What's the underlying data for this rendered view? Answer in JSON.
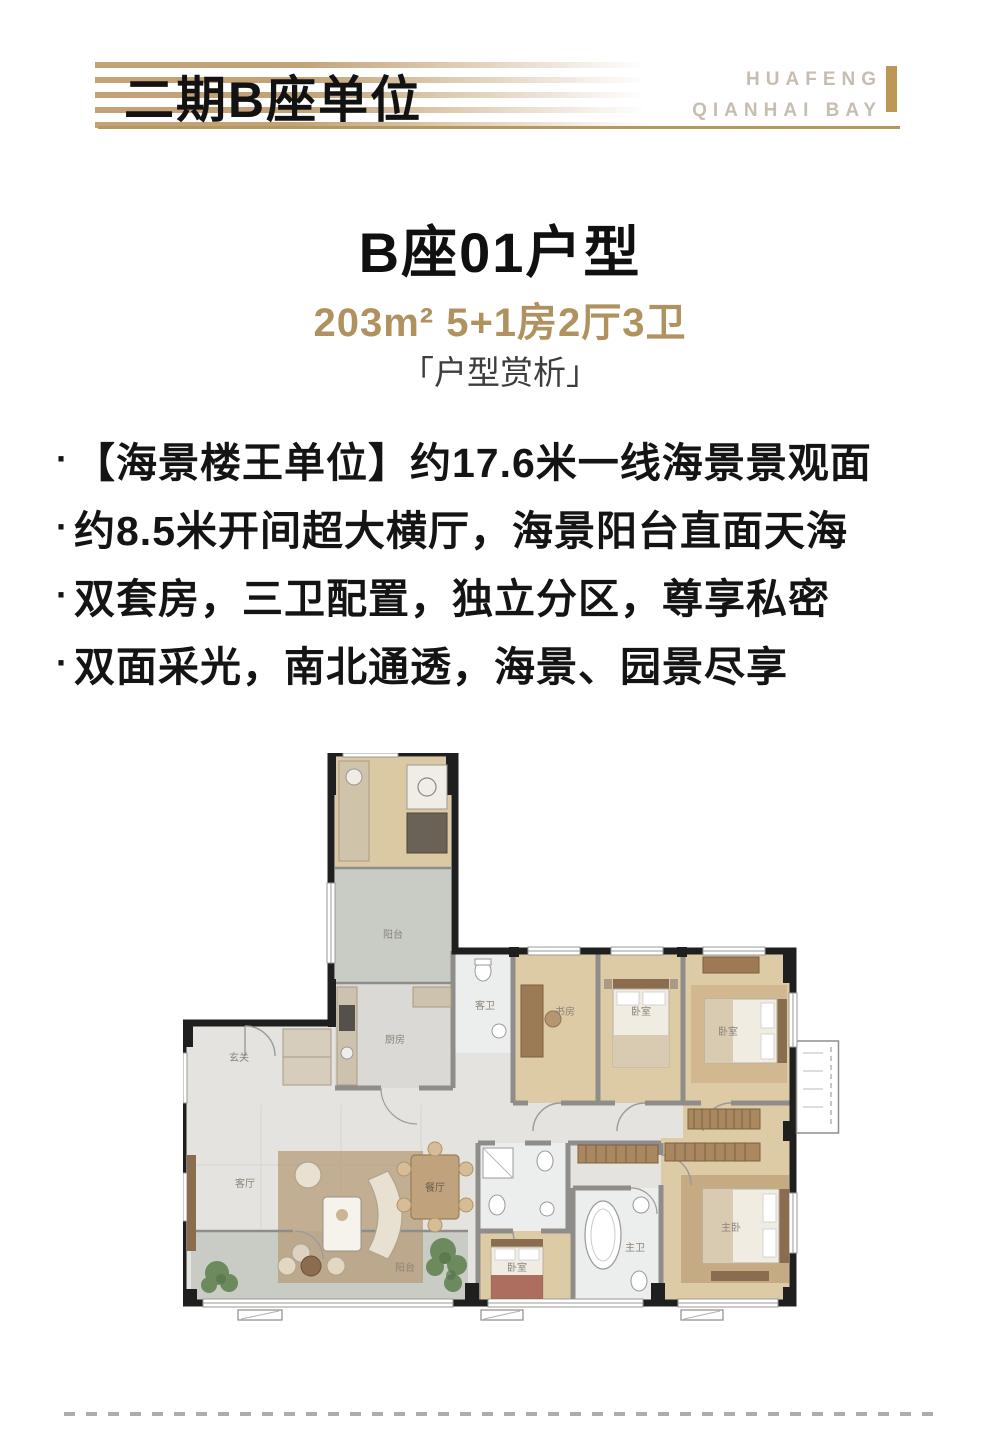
{
  "header": {
    "title": "二期B座单位",
    "brand_line1": "HUAFENG",
    "brand_line2": "QIANHAI BAY"
  },
  "unit": {
    "title": "B座01户型",
    "spec": "203m² 5+1房2厅3卫",
    "section_label": "「户型赏析」"
  },
  "features": {
    "bullet": "·",
    "items": [
      "【海景楼王单位】约17.6米一线海景景观面",
      "约8.5米开间超大横厅，海景阳台直面天海",
      "双套房，三卫配置，独立分区，尊享私密",
      "双面采光，南北通透，海景、园景尽享"
    ]
  },
  "floorplan": {
    "labels": {
      "north_balcony": "阳台",
      "kitchen": "厨房",
      "guest_bath": "客卫",
      "entry": "玄关",
      "study": "书房",
      "bedroom_1": "卧室",
      "bedroom_2": "卧室",
      "bedroom_3": "卧室",
      "living": "客厅",
      "dining": "餐厅",
      "master_bath": "主卫",
      "master_bedroom": "主卧",
      "south_balcony": "阳台"
    }
  },
  "colors": {
    "accent_gold": "#b6985f",
    "brand_bar_gold": "#bd9755",
    "spec_gold": "#b09260",
    "brand_text": "#c6beb1",
    "text_black": "#141414",
    "plan_wood": "#ddcba6",
    "plan_tile": "#e4e3df",
    "plan_balcony": "#c8ccc5"
  }
}
